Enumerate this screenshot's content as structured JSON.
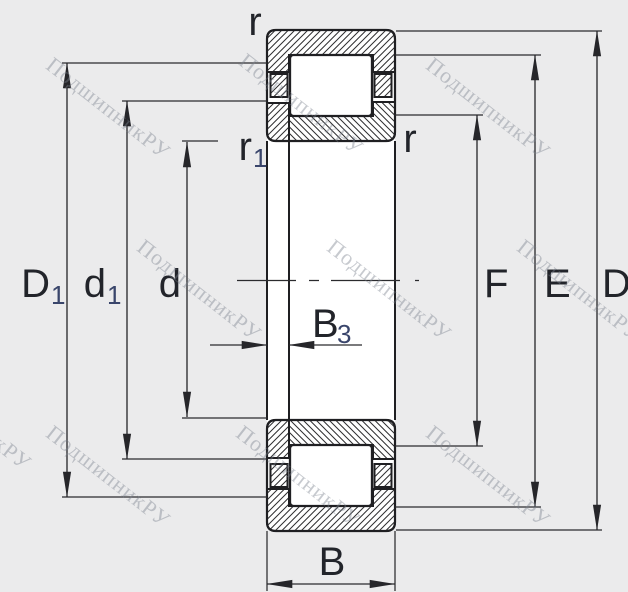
{
  "title": "Cylindrical roller bearing cross-section drawing",
  "watermark": {
    "text": "ПодшипникРУ"
  },
  "labels": {
    "r_top": "r",
    "r_right": "r",
    "r1": {
      "main": "r",
      "sub": "1"
    },
    "D1": {
      "main": "D",
      "sub": "1"
    },
    "d1": {
      "main": "d",
      "sub": "1"
    },
    "d": "d",
    "B3": {
      "main": "B",
      "sub": "3"
    },
    "F": "F",
    "E": "E",
    "D": "D",
    "B": "B"
  },
  "colors": {
    "background": "#ebebec",
    "line": "#26262a",
    "label": "#22242a",
    "subscript": "#39456b",
    "fill_white": "#ffffff",
    "watermark": "#8a8f9a"
  }
}
